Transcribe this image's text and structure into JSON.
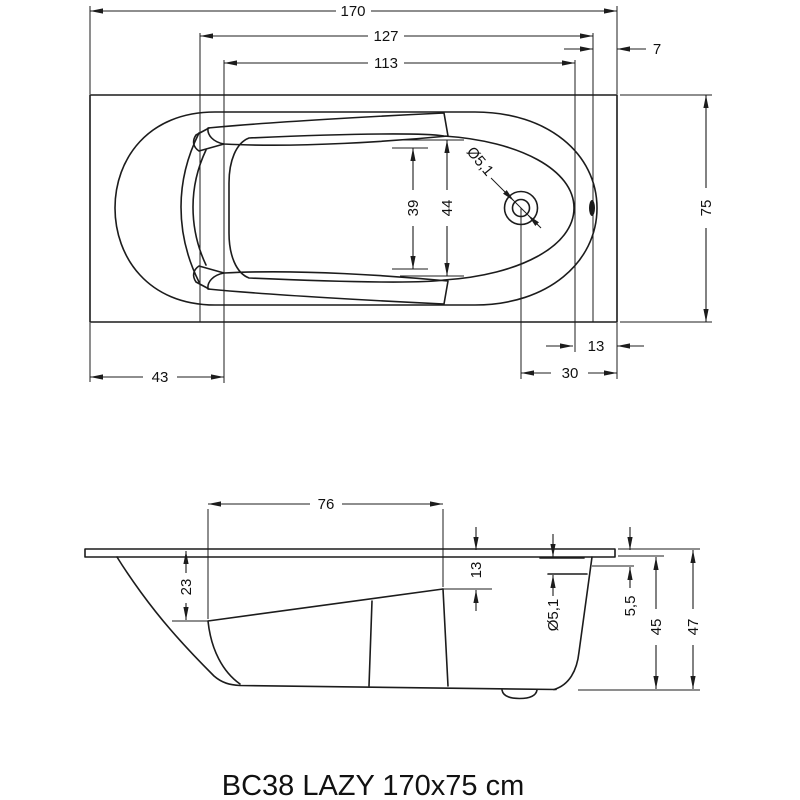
{
  "caption": "BC38 LAZY 170x75 cm",
  "top_view": {
    "overall_length": "170",
    "rim_length": "127",
    "basin_length": "113",
    "rim_edge_offset": "7",
    "overall_width": "75",
    "seat_width": "39",
    "basin_width": "44",
    "drain_diameter": "Ø5,1",
    "backrest_offset": "43",
    "drain_to_edge": "13",
    "drain_center_to_edge": "30"
  },
  "side_view": {
    "seat_length": "76",
    "backrest_drop": "23",
    "rim_to_seat_top": "13",
    "overflow_diameter": "Ø5,1",
    "overflow_center_offset": "5,5",
    "shell_height": "45",
    "overall_height": "47"
  }
}
